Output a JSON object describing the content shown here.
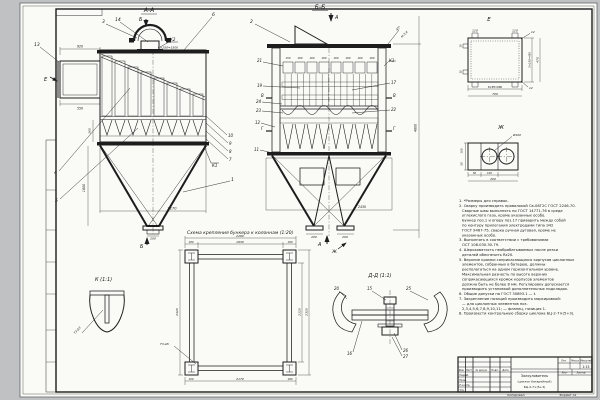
{
  "sheet": {
    "bg": "#bfc1c3",
    "paper": "#fafaf7",
    "ink": "#1d1d1d"
  },
  "view_aa": {
    "label": "А-А",
    "sec_top": "Б",
    "sec_bottom": "Б",
    "view_arrow_e": "Е",
    "c1": "1",
    "c3": "3",
    "c4": "4",
    "c5": "5",
    "c6": "6",
    "c7": "7",
    "c8": "8",
    "c9": "9",
    "c10": "10",
    "c13": "13",
    "c14": "14",
    "k1": "К1",
    "k2": "К2",
    "dim_pitch": "6×250=1500",
    "dim_inlet_w": "920",
    "dim_inlet_h": "550",
    "dim_hopper_w": "2170",
    "dim_outlet": "200",
    "dim_hopper_h": "1800",
    "dim_plate": "160"
  },
  "view_bb": {
    "label": "Б-Б",
    "sec_top": "А",
    "sec_bottom": "А",
    "view_arrow_zh": "Ж",
    "c2": "2",
    "c11": "11",
    "c12": "12",
    "c17": "17",
    "c19": "19",
    "c21": "21",
    "c22": "22",
    "c23": "23",
    "c24": "24",
    "k1": "К1",
    "sec_v": "В",
    "sec_g": "Г",
    "weld_angle": "45°",
    "weld_note": "Н-3,4",
    "dims_top": [
      "150",
      "190",
      "190",
      "190",
      "190",
      "190",
      "190",
      "190"
    ],
    "dim_frame": "2430",
    "dim_height": "4800",
    "dim_outlet_l": "200",
    "dim_outlet_r": "200"
  },
  "view_e": {
    "label": "Е",
    "dim_tab_l": "110",
    "dim_tab_r": "110",
    "hole_tr": "12",
    "hole_br": "12",
    "dim_right_chain": "3×150=450",
    "dim_right_total": "470",
    "dim_bottom_chain": "8×85=680",
    "dim_bottom_total": "700",
    "dim_thk_top": "10",
    "dim_thk_bot": "10"
  },
  "view_zh": {
    "label": "Ж",
    "hole_dia": "Ø100",
    "dim_left_top": "100",
    "dim_left_bot": "50",
    "dim_bot_1": "50",
    "dim_bot_2": "100",
    "dim_bot_total": "200"
  },
  "plan": {
    "caption": "Схема крепления бункера к колоннам (1:20)",
    "dim_top_l": "180",
    "dim_top_mid": "1930",
    "dim_top_r": "180",
    "dim_top_total": "2290",
    "dim_left": "2420",
    "dim_right_inner": "2120",
    "dim_right_outer": "2320",
    "dim_bot_l": "100",
    "dim_bot_mid": "2170",
    "dim_bot_r": "180",
    "weld": "Т3-Δ5"
  },
  "detail_k": {
    "label": "К (1:1)",
    "weld": "Т3-Δ3"
  },
  "detail_dd": {
    "label": "Д-Д (1:1)",
    "c15": "15",
    "c16": "16",
    "c20": "20",
    "c25": "25",
    "c26": "26",
    "c27": "27"
  },
  "notes": {
    "lines": [
      "1. *Размеры для справок.",
      "2. Сварку производить проволокой Св-08Г2С ГОСТ 2246-70.",
      "Сварные швы выполнять по ГОСТ 14771-76 в среде",
      "углекислого газа, кроме указанных особо.",
      "Бункер поз.1 и опору поз.17 приварить между собой",
      "по контуру прилегания электродами типа Э42",
      "ГОСТ 9467-75, сварка ручная дуговая, кроме не",
      "указанных особо.",
      "3. Выполнять в соответствии с требованиями",
      "ОСТ 108.030.30-79.",
      "4. Шероховатость необрабатываемых после резки",
      "деталей обеспечить Rz20.",
      "5. Верхние кромки соприкасающихся корпусов циклонных",
      "элементов, собранных в батарею, должны",
      "располагаться на одном горизонтальном уровне.",
      "Максимальная разность по высоте верхних",
      "соприкасающихся кромок корпусов элементов",
      "должна быть не более 8 мм. Регулировку допускается",
      "производить установкой дополнительных подкладок.",
      "6. Общие допуски по ГОСТ 30893.1 — t.",
      "7. Закрепление позиций производить маркировкой:",
      "— для циклонных элементов поз.",
      "2,3,4,5,6,7,8,9,10,11;  — фланец, позиция 1.",
      "8. Произвести контрольную сборку циклона БЦ-2-7×(5+3)."
    ]
  },
  "titleblock": {
    "name1": "Золоуловитель",
    "name2": "(циклон батарейный)",
    "name3": "БЦ-2-7×(5+3)",
    "scale": "1:15",
    "h_izm": "Изм.",
    "h_list": "Лист",
    "h_doc": "№ докум.",
    "h_sign": "Подп.",
    "h_date": "Дата",
    "r1": "Разраб.",
    "r2": "Пров.",
    "r3": "Н.контр.",
    "r4": "Утв.",
    "lit": "Лит.",
    "mass": "Масса",
    "masshtab": "Масштаб",
    "sheet_lbl": "Лист",
    "sheets_lbl": "Листов",
    "copied": "Копировал",
    "format": "Формат A1"
  }
}
